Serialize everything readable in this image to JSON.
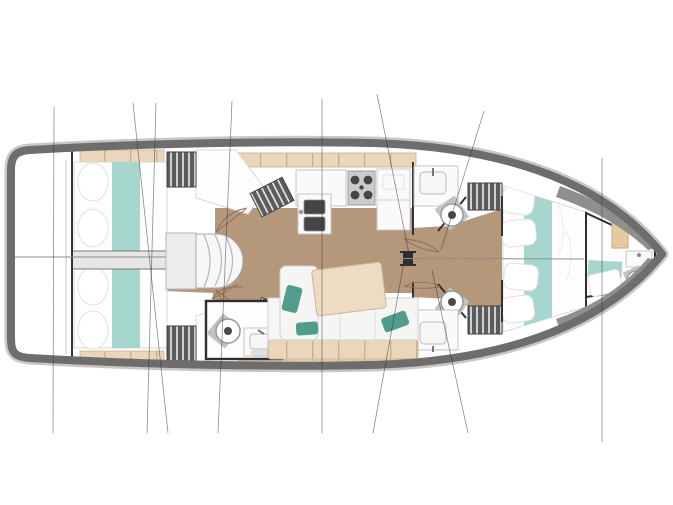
{
  "diagram_label": "sailboat-interior-floor-plan",
  "rooms": [
    "stern-swim-platform",
    "aft-cabin-port",
    "aft-cabin-starboard",
    "companionway-stairs",
    "galley",
    "salon",
    "head-aft-starboard",
    "head-forward-port",
    "head-forward-starboard",
    "forward-master-cabin",
    "bow-cabin-with-head",
    "mast",
    "rigging-lines"
  ],
  "fixtures": [
    "double-berth",
    "teal-runner",
    "pillow",
    "hanging-locker",
    "stove",
    "double-sink",
    "refrigerator-counter",
    "toilet",
    "washbasin",
    "sofa",
    "saloon-table",
    "throw-pillow",
    "door-swing-arc",
    "centerline"
  ],
  "palette": {
    "page_bg": "#ffffff",
    "hull_border": "#6e6d6b",
    "hull_halo": "#c8c7c5",
    "deck": "#ffffff",
    "floor_wood": "#b5977b",
    "bed_teal": "#a6d6ce",
    "beige_locker": "#e9d6bb",
    "beige_edge": "#cbb190",
    "counter_white": "#fafafa",
    "counter_edge": "#c6c6c6",
    "fixture_dark": "#454545",
    "stove_panel": "#cbcbcb",
    "stripe_dark": "#5c5c5c",
    "stripe_light": "#ededed",
    "wall_dark": "#333333",
    "table_wood": "#eedbc4",
    "table_edge": "#cdb493",
    "sofa_white": "#f5f5f3",
    "sofa_edge": "#d2d2d0",
    "pillow_teal": "#519c8c",
    "gray_band": "#e6e6e5",
    "toilet_ring": "#9a9a9a",
    "plinth_gray": "#c2c2c2",
    "centerline": "#8f8f8f",
    "rig_line": "#2f2f2f",
    "stairs_fill": "#f7f7f7",
    "stairs_edge": "#a8a8a8"
  }
}
